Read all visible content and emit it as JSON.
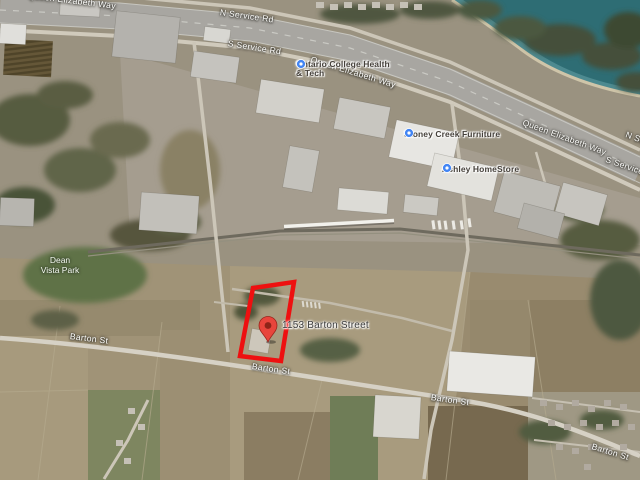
{
  "map": {
    "road_labels": {
      "qew_top": "Queen Elizabeth Way",
      "n_service_top": "N Service Rd",
      "s_service_top": "S Service Rd",
      "qew_mid": "Queen Elizabeth Way",
      "qew_right": "Queen Elizabeth Way",
      "n_service_right": "N Service Rd",
      "s_service_right": "S Service Rd",
      "barton_left": "Barton St",
      "barton_mid": "Barton St",
      "barton_right": "Barton St",
      "barton_far_right": "Barton St"
    },
    "pois": [
      {
        "line1": "Ontario College Health",
        "line2": "& Tech"
      },
      {
        "name": "Stoney Creek Furniture"
      },
      {
        "name": "Ashley HomeStore"
      }
    ],
    "park": {
      "line1": "Dean",
      "line2": "Vista Park"
    },
    "property": {
      "address": "1153 Barton Street"
    },
    "colors": {
      "parcel_outline": "#ee1010",
      "pin_fill": "#e8453c",
      "pin_dot": "#8e2418",
      "poi_icon": "#4285f4",
      "water": "#2e6d74"
    }
  }
}
